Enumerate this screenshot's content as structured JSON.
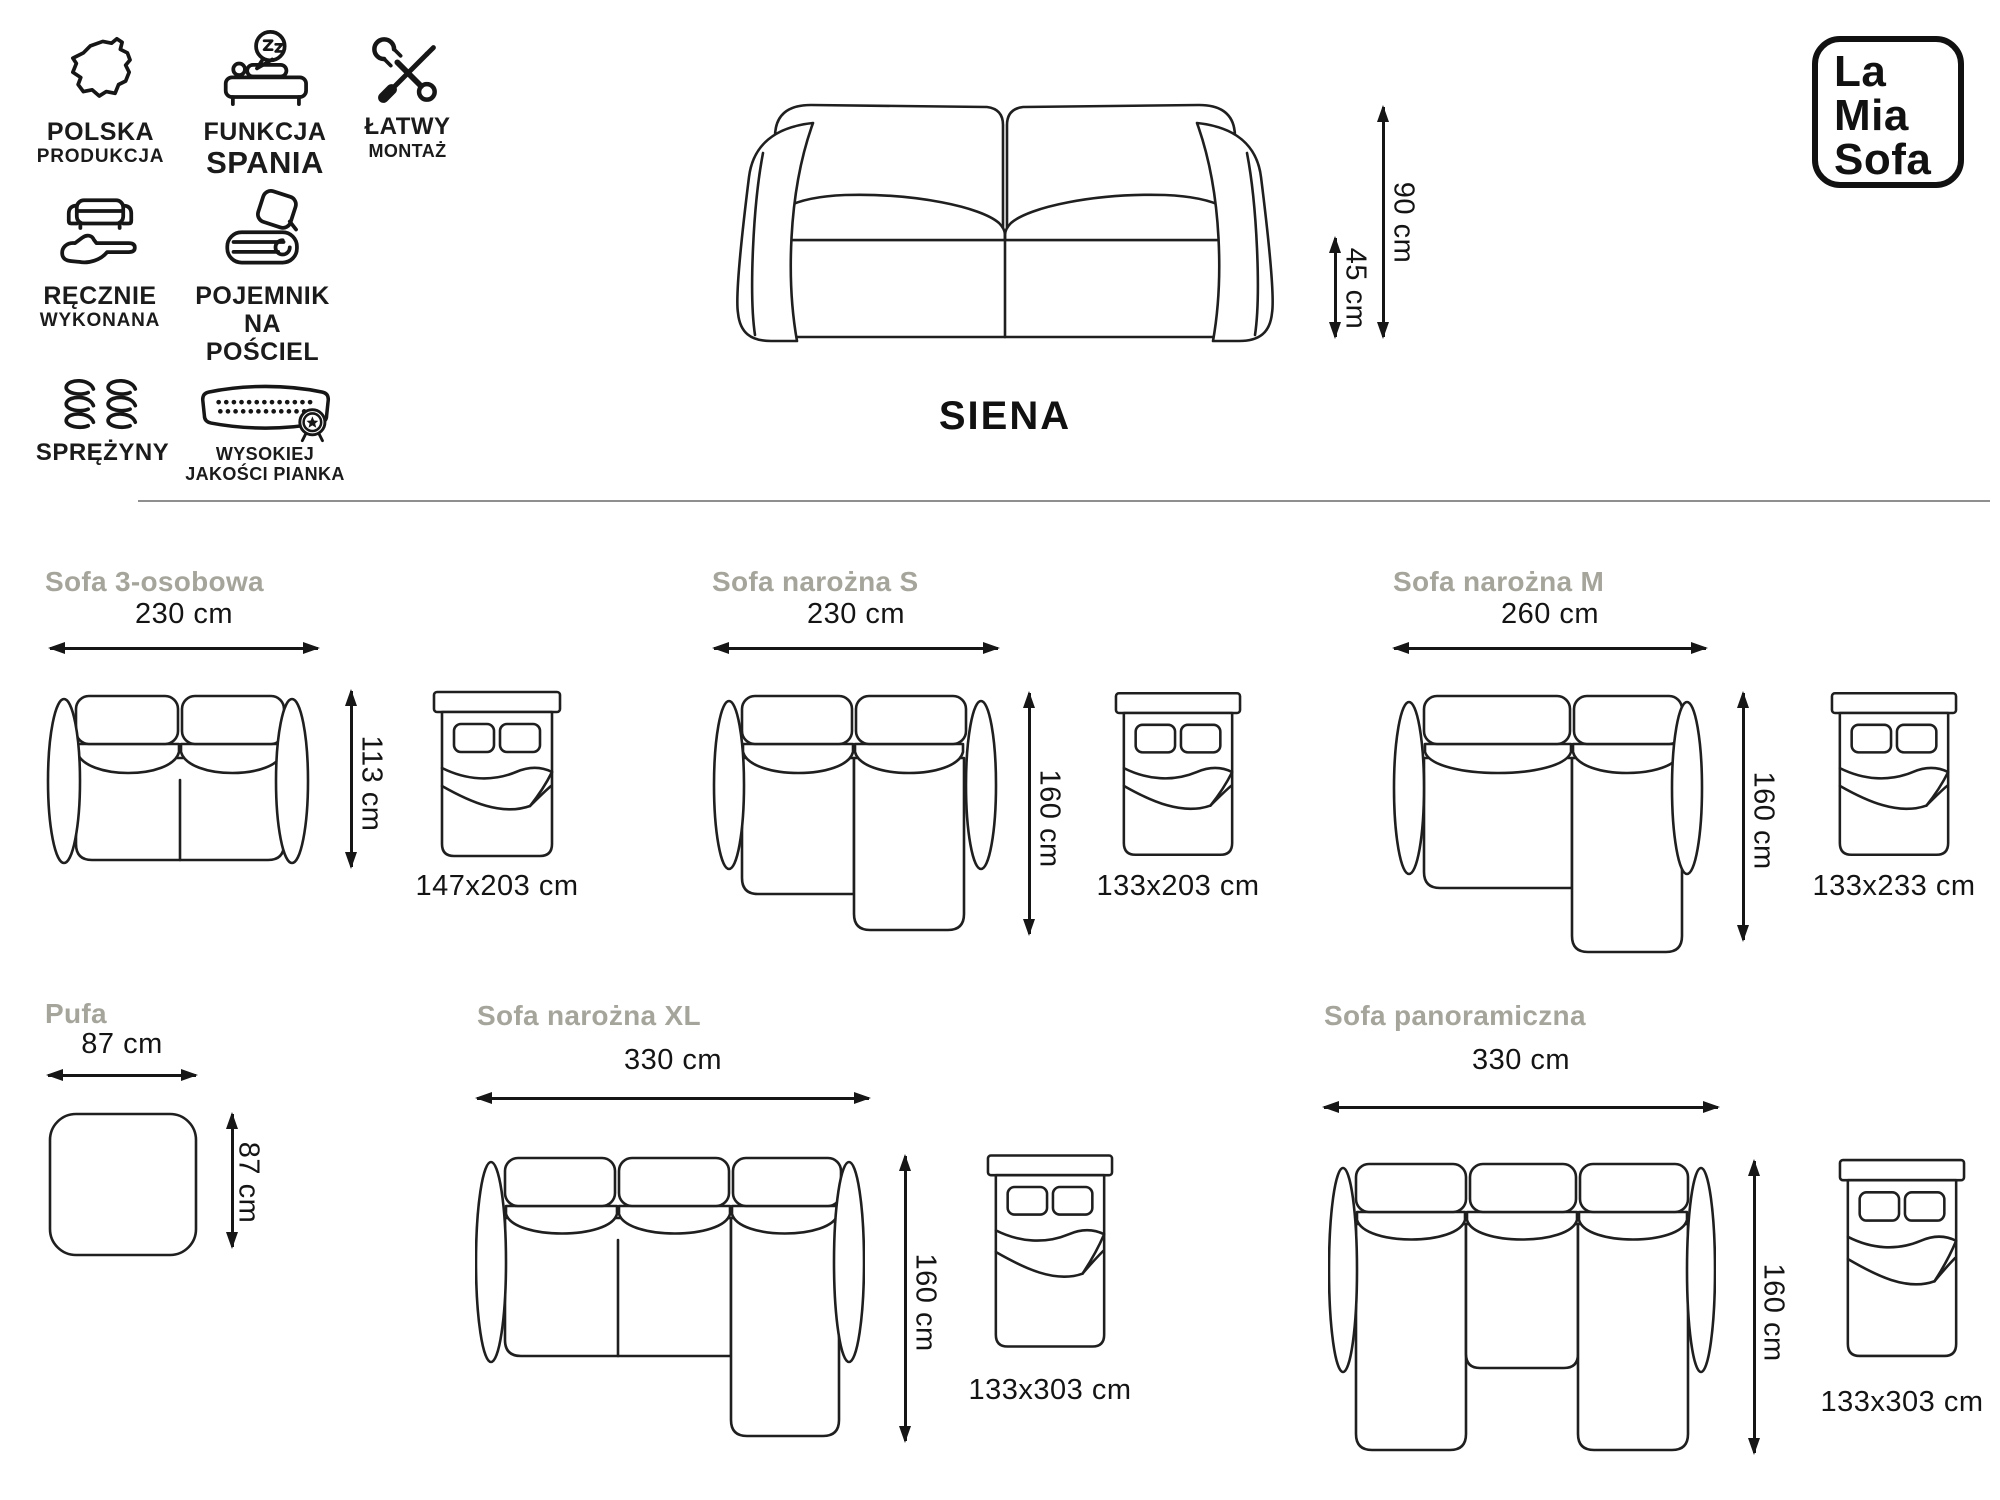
{
  "title": "SIENA",
  "logo": {
    "line1": "La",
    "line2": "Mia",
    "line3": "Sofa"
  },
  "features": [
    {
      "lines": [
        "POLSKA",
        "PRODUKCJA"
      ]
    },
    {
      "lines": [
        "FUNKCJA",
        "SPANIA"
      ]
    },
    {
      "lines": [
        "ŁATWY",
        "MONTAŻ"
      ]
    },
    {
      "lines": [
        "RĘCZNIE",
        "WYKONANA"
      ]
    },
    {
      "lines": [
        "POJEMNIK",
        "NA POŚCIEL"
      ]
    },
    {
      "lines": [
        "SPRĘŻYNY"
      ]
    },
    {
      "lines": [
        "WYSOKIEJ",
        "JAKOŚCI PIANKA"
      ]
    }
  ],
  "hero": {
    "height": "90 cm",
    "seat_height": "45 cm"
  },
  "variants": [
    {
      "name": "Sofa 3-osobowa",
      "width": "230 cm",
      "depth": "113 cm",
      "bed": "147x203 cm"
    },
    {
      "name": "Sofa narożna S",
      "width": "230 cm",
      "depth": "160 cm",
      "bed": "133x203 cm"
    },
    {
      "name": "Sofa narożna M",
      "width": "260 cm",
      "depth": "160 cm",
      "bed": "133x233 cm"
    },
    {
      "name": "Pufa",
      "width": "87 cm",
      "depth": "87 cm"
    },
    {
      "name": "Sofa narożna XL",
      "width": "330 cm",
      "depth": "160 cm",
      "bed": "133x303 cm"
    },
    {
      "name": "Sofa panoramiczna",
      "width": "330 cm",
      "depth": "160 cm",
      "bed": "133x303 cm"
    }
  ]
}
